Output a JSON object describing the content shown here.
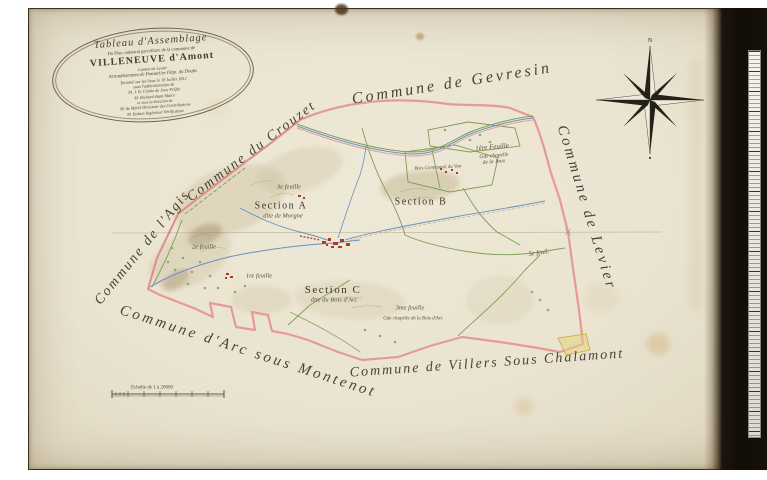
{
  "cartouche": {
    "lines": [
      "Tableau d'Assemblage",
      "Du Plan cadastral parcellaire de la commune de",
      "VILLENEUVE d'Amont",
      "Canton de Levier",
      "Arrondissement de Pontarlier Dépt. du Doubs",
      "Terminé sur les lieux le 10 Juillet 1812",
      "sous l'administration de",
      "M. J. B. Comte de Jouy Préfet",
      "M. Richard étant Maire",
      "et sous la direction de",
      "M. de Mérel Directeur des Contributions",
      "M. Robert Ingénieur Vérificateur"
    ]
  },
  "compass": {
    "north_label": "N"
  },
  "neighbors": {
    "gevresin": "Commune de Gevresin",
    "crouzet": "Commune du Crouzet",
    "agis": "Commune de l'Agis",
    "levier": "Commune de Levier",
    "arc": "Commune d'Arc sous Montenot",
    "villers": "Commune de Villers Sous Chalamont"
  },
  "sections": {
    "a": {
      "name": "Section A",
      "subtitle": "dite de Morgne"
    },
    "b": {
      "name": "Section B"
    },
    "c": {
      "name": "Section C",
      "subtitle": "dite du Bois d'Arc"
    }
  },
  "sheets": [
    {
      "text": "1ère Feuille",
      "note1": "Gde chapelle",
      "note2": "de la Joux"
    },
    {
      "text": "3e feuille"
    },
    {
      "text": "2e feuille"
    },
    {
      "text": "1re feuille"
    },
    {
      "text": "5e feuil."
    },
    {
      "text": "3me feuille",
      "note1": "Gde chapelle de la Bois d'Arc"
    }
  ],
  "annotations": {
    "bois_communal": "Bois Communal du Van"
  },
  "scale_bar": {
    "label": "Echelle de 1 à 20000"
  },
  "colors": {
    "paper": "#e9e3d0",
    "boundary_pink": "#e59a98",
    "section_green": "#7d9e54",
    "road_blue": "#6c8fc2",
    "building_red": "#a63d2a",
    "ink": "#4a4138"
  }
}
